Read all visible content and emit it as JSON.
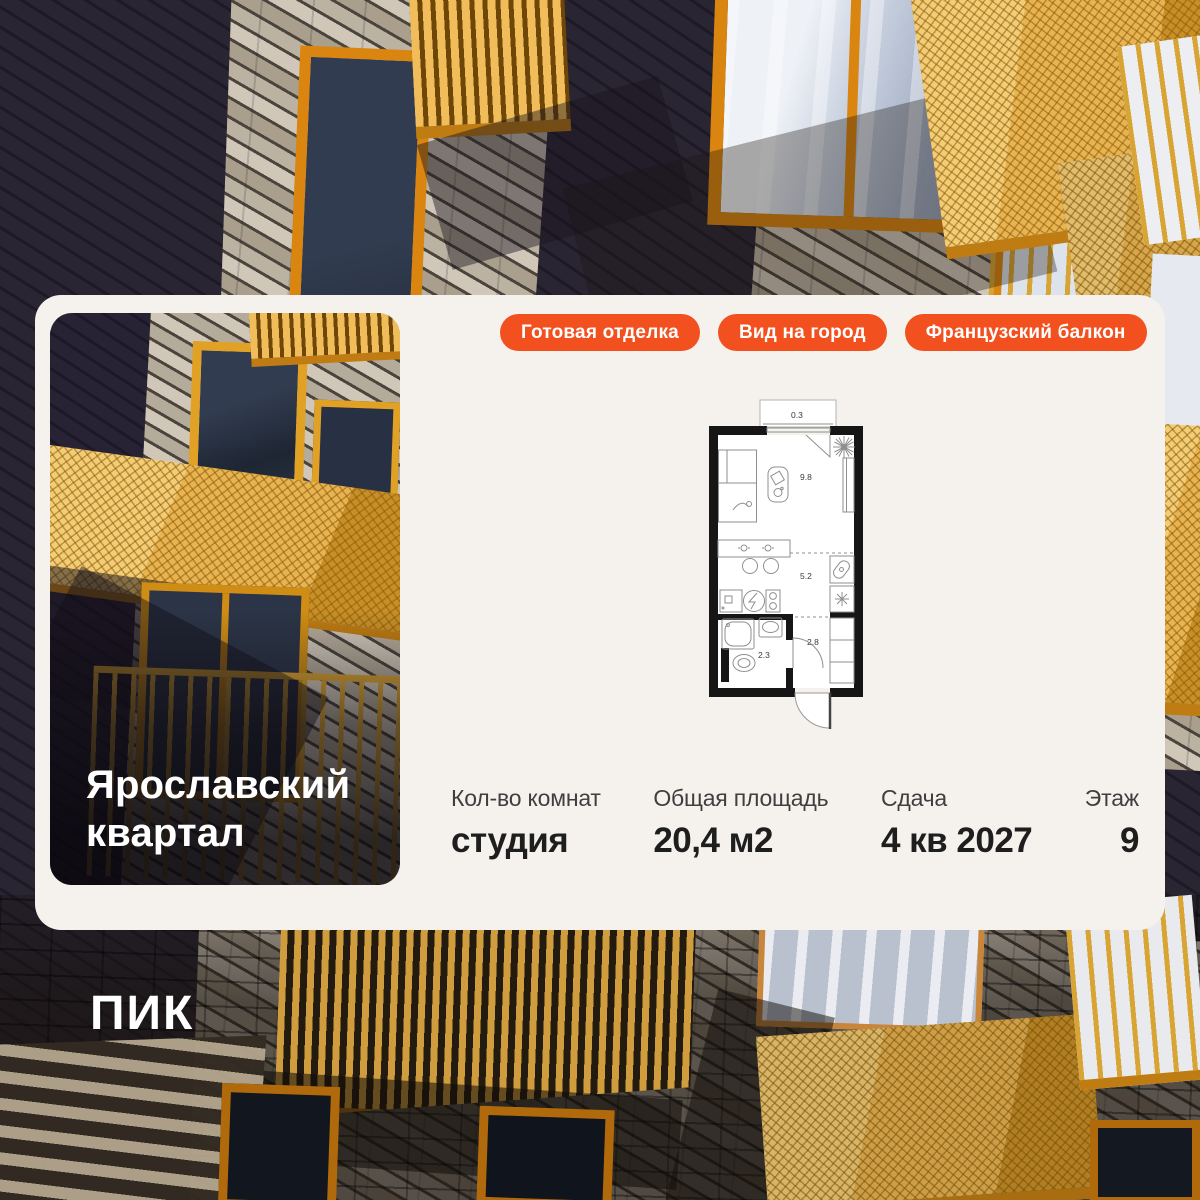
{
  "badges": {
    "finish": "Готовая отделка",
    "view": "Вид на город",
    "balcony": "Французский балкон"
  },
  "project": {
    "title_line1": "Ярославский",
    "title_line2": "квартал"
  },
  "floor_plan": {
    "balcony_area": "0.3",
    "room_area": "9.8",
    "kitchen_area": "5.2",
    "bathroom_area": "2.3",
    "hallway_area": "2.8"
  },
  "details": {
    "rooms_label": "Кол-во комнат",
    "rooms_value": "студия",
    "area_label": "Общая площадь",
    "area_value": "20,4 м2",
    "delivery_label": "Сдача",
    "delivery_value": "4 кв 2027",
    "floor_label": "Этаж",
    "floor_value": "9"
  },
  "brand": {
    "logo": "ПИК"
  },
  "colors": {
    "accent_orange": "#F2501E",
    "card_bg": "#F5F1ED",
    "balcony_gold": "#E9B44F",
    "window_frame_orange": "#D9850F",
    "facade_dark": "#242030"
  }
}
